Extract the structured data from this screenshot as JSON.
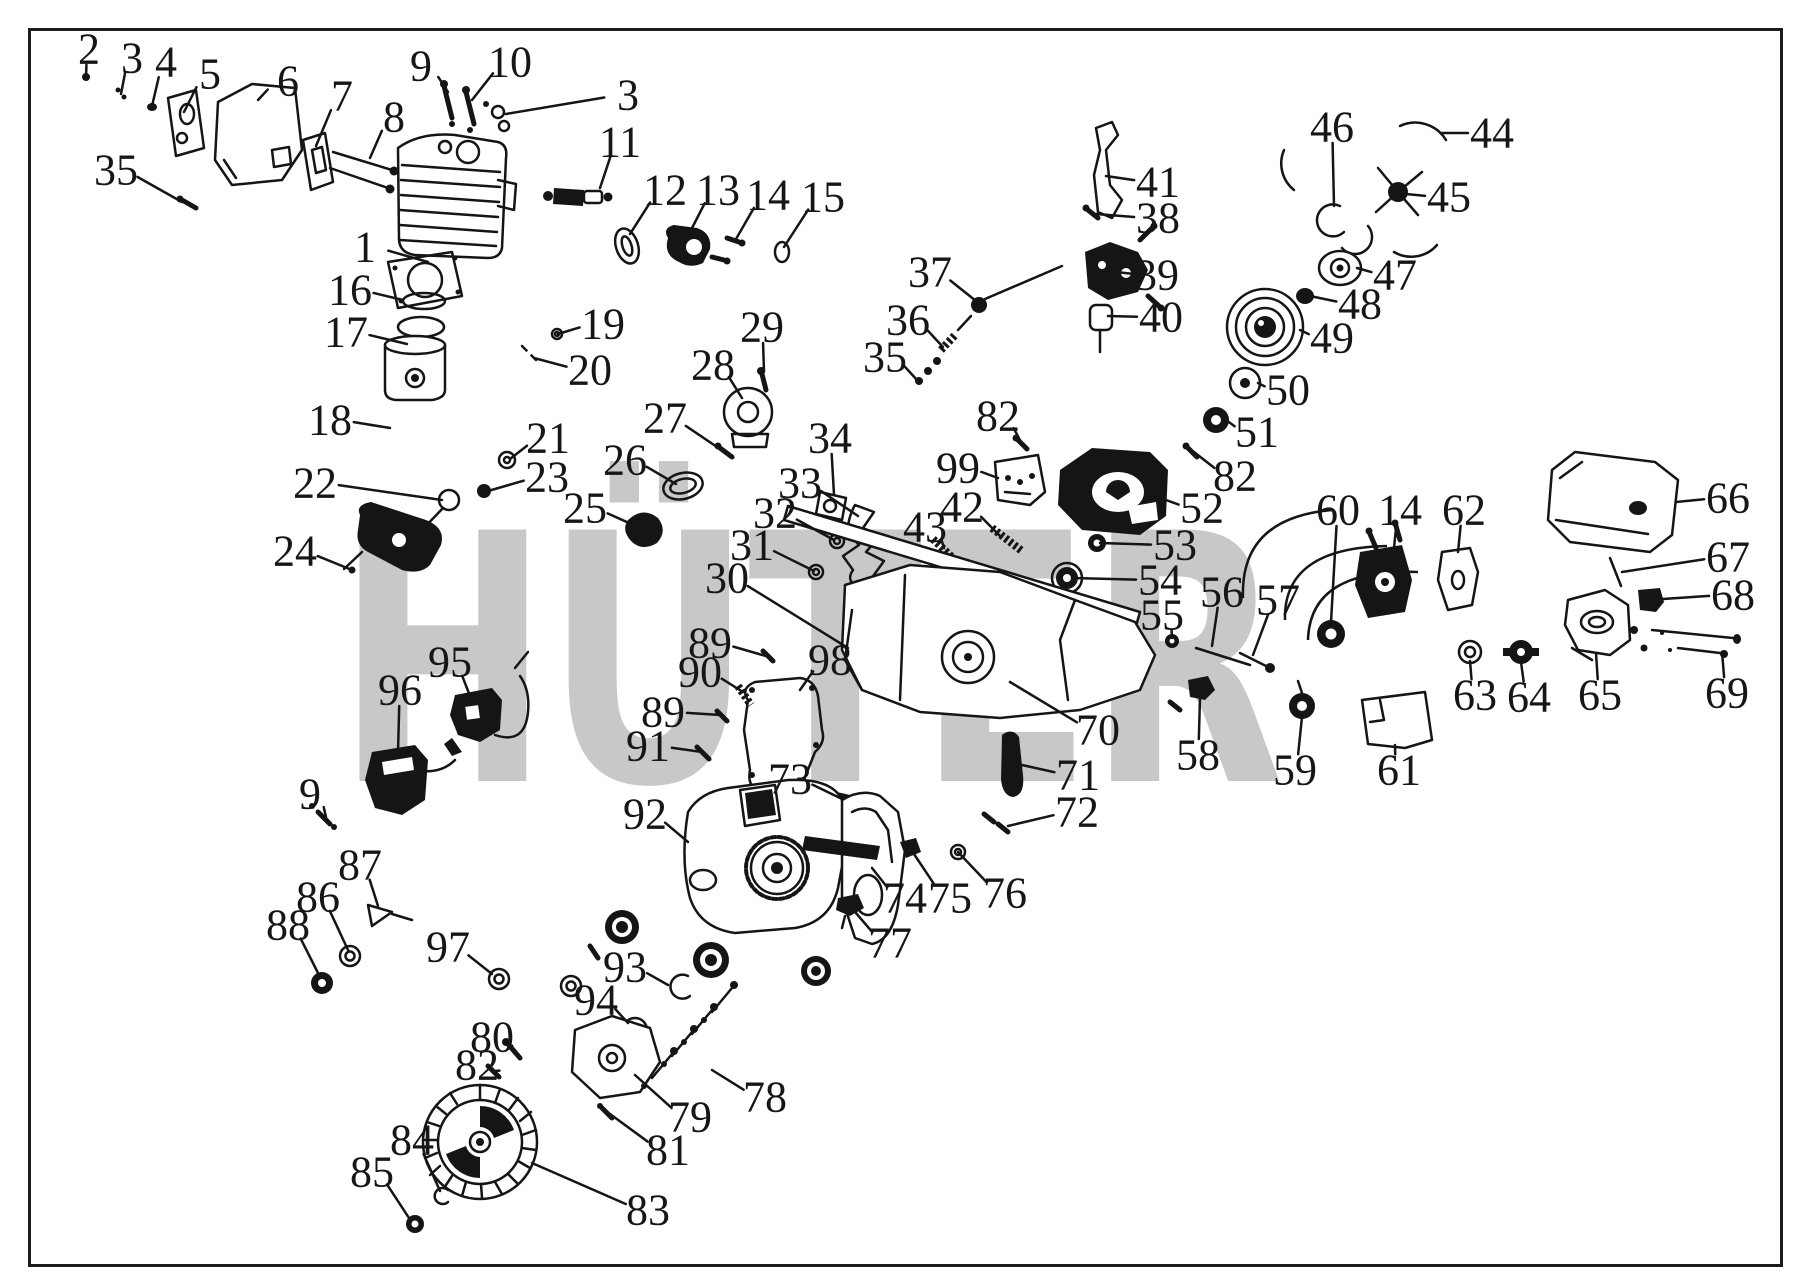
{
  "figure": {
    "type": "exploded-parts-diagram",
    "subject": "chainsaw engine assembly"
  },
  "watermark": {
    "text": "HÜTER",
    "text_color": "#c8c8c8",
    "emblem": {
      "gray": "#bdbdbd",
      "red": "#f0a0ab",
      "yellow": "#f6f2a6"
    }
  },
  "frame_color": "#1c1c1c",
  "ink_color": "#151515",
  "callouts": [
    {
      "n": "1",
      "x": 365,
      "y": 247,
      "tx": 428,
      "ty": 262
    },
    {
      "n": "2",
      "x": 89,
      "y": 49,
      "tx": 86,
      "ty": 77
    },
    {
      "n": "3",
      "x": 132,
      "y": 58,
      "tx": 121,
      "ty": 94
    },
    {
      "n": "3",
      "x": 628,
      "y": 95,
      "tx": 506,
      "ty": 114
    },
    {
      "n": "4",
      "x": 166,
      "y": 62,
      "tx": 152,
      "ty": 106
    },
    {
      "n": "5",
      "x": 210,
      "y": 74,
      "tx": 184,
      "ty": 112
    },
    {
      "n": "6",
      "x": 288,
      "y": 81,
      "tx": 258,
      "ty": 100
    },
    {
      "n": "7",
      "x": 342,
      "y": 96,
      "tx": 316,
      "ty": 146
    },
    {
      "n": "8",
      "x": 394,
      "y": 117,
      "tx": 370,
      "ty": 158
    },
    {
      "n": "9",
      "x": 421,
      "y": 66,
      "tx": 448,
      "ty": 92
    },
    {
      "n": "9",
      "x": 310,
      "y": 794,
      "tx": 326,
      "ty": 817
    },
    {
      "n": "10",
      "x": 510,
      "y": 62,
      "tx": 472,
      "ty": 100
    },
    {
      "n": "11",
      "x": 620,
      "y": 142,
      "tx": 600,
      "ty": 188
    },
    {
      "n": "12",
      "x": 665,
      "y": 190,
      "tx": 630,
      "ty": 234
    },
    {
      "n": "13",
      "x": 718,
      "y": 190,
      "tx": 690,
      "ty": 232
    },
    {
      "n": "14",
      "x": 768,
      "y": 195,
      "tx": 736,
      "ty": 239
    },
    {
      "n": "14",
      "x": 1400,
      "y": 510,
      "tx": 1394,
      "ty": 548
    },
    {
      "n": "15",
      "x": 823,
      "y": 197,
      "tx": 784,
      "ty": 247
    },
    {
      "n": "16",
      "x": 350,
      "y": 290,
      "tx": 403,
      "ty": 300
    },
    {
      "n": "17",
      "x": 346,
      "y": 332,
      "tx": 407,
      "ty": 344
    },
    {
      "n": "18",
      "x": 330,
      "y": 420,
      "tx": 390,
      "ty": 428
    },
    {
      "n": "19",
      "x": 603,
      "y": 324,
      "tx": 558,
      "ty": 334
    },
    {
      "n": "20",
      "x": 590,
      "y": 370,
      "tx": 534,
      "ty": 358
    },
    {
      "n": "21",
      "x": 548,
      "y": 438,
      "tx": 510,
      "ty": 459
    },
    {
      "n": "22",
      "x": 315,
      "y": 483,
      "tx": 442,
      "ty": 500
    },
    {
      "n": "23",
      "x": 547,
      "y": 477,
      "tx": 488,
      "ty": 491
    },
    {
      "n": "24",
      "x": 295,
      "y": 551,
      "tx": 352,
      "ty": 570
    },
    {
      "n": "25",
      "x": 585,
      "y": 508,
      "tx": 638,
      "ty": 527
    },
    {
      "n": "26",
      "x": 625,
      "y": 460,
      "tx": 676,
      "ty": 484
    },
    {
      "n": "27",
      "x": 665,
      "y": 418,
      "tx": 723,
      "ty": 451
    },
    {
      "n": "28",
      "x": 713,
      "y": 365,
      "tx": 742,
      "ty": 398
    },
    {
      "n": "29",
      "x": 762,
      "y": 327,
      "tx": 764,
      "ty": 372
    },
    {
      "n": "30",
      "x": 727,
      "y": 578,
      "tx": 848,
      "ty": 648
    },
    {
      "n": "31",
      "x": 752,
      "y": 545,
      "tx": 814,
      "ty": 571
    },
    {
      "n": "32",
      "x": 775,
      "y": 513,
      "tx": 834,
      "ty": 540
    },
    {
      "n": "33",
      "x": 800,
      "y": 483,
      "tx": 858,
      "ty": 516
    },
    {
      "n": "34",
      "x": 830,
      "y": 438,
      "tx": 834,
      "ty": 495
    },
    {
      "n": "35",
      "x": 116,
      "y": 170,
      "tx": 182,
      "ty": 202
    },
    {
      "n": "35",
      "x": 885,
      "y": 357,
      "tx": 917,
      "ty": 380
    },
    {
      "n": "36",
      "x": 908,
      "y": 320,
      "tx": 943,
      "ty": 347
    },
    {
      "n": "37",
      "x": 930,
      "y": 272,
      "tx": 976,
      "ty": 301
    },
    {
      "n": "38",
      "x": 1158,
      "y": 218,
      "tx": 1096,
      "ty": 214
    },
    {
      "n": "39",
      "x": 1157,
      "y": 275,
      "tx": 1116,
      "ty": 272
    },
    {
      "n": "40",
      "x": 1161,
      "y": 317,
      "tx": 1108,
      "ty": 316
    },
    {
      "n": "41",
      "x": 1158,
      "y": 182,
      "tx": 1106,
      "ty": 176
    },
    {
      "n": "42",
      "x": 962,
      "y": 507,
      "tx": 1000,
      "ty": 536
    },
    {
      "n": "43",
      "x": 925,
      "y": 527,
      "tx": 944,
      "ty": 548
    },
    {
      "n": "44",
      "x": 1492,
      "y": 133,
      "tx": 1442,
      "ty": 133
    },
    {
      "n": "45",
      "x": 1449,
      "y": 197,
      "tx": 1406,
      "ty": 194
    },
    {
      "n": "46",
      "x": 1332,
      "y": 127,
      "tx": 1334,
      "ty": 206
    },
    {
      "n": "47",
      "x": 1395,
      "y": 275,
      "tx": 1357,
      "ty": 268
    },
    {
      "n": "48",
      "x": 1360,
      "y": 304,
      "tx": 1310,
      "ty": 296
    },
    {
      "n": "49",
      "x": 1332,
      "y": 338,
      "tx": 1300,
      "ty": 330
    },
    {
      "n": "50",
      "x": 1288,
      "y": 390,
      "tx": 1258,
      "ty": 383
    },
    {
      "n": "51",
      "x": 1257,
      "y": 432,
      "tx": 1226,
      "ty": 420
    },
    {
      "n": "52",
      "x": 1202,
      "y": 508,
      "tx": 1166,
      "ty": 500
    },
    {
      "n": "53",
      "x": 1175,
      "y": 545,
      "tx": 1100,
      "ty": 543
    },
    {
      "n": "54",
      "x": 1160,
      "y": 580,
      "tx": 1072,
      "ty": 578
    },
    {
      "n": "55",
      "x": 1162,
      "y": 615,
      "tx": 1172,
      "ty": 638
    },
    {
      "n": "56",
      "x": 1222,
      "y": 592,
      "tx": 1212,
      "ty": 646
    },
    {
      "n": "57",
      "x": 1278,
      "y": 600,
      "tx": 1253,
      "ty": 655
    },
    {
      "n": "58",
      "x": 1198,
      "y": 755,
      "tx": 1200,
      "ty": 698
    },
    {
      "n": "59",
      "x": 1295,
      "y": 770,
      "tx": 1302,
      "ty": 717
    },
    {
      "n": "60",
      "x": 1338,
      "y": 510,
      "tx": 1331,
      "ty": 622
    },
    {
      "n": "61",
      "x": 1399,
      "y": 770,
      "tx": 1395,
      "ty": 745
    },
    {
      "n": "62",
      "x": 1464,
      "y": 510,
      "tx": 1458,
      "ty": 552
    },
    {
      "n": "63",
      "x": 1475,
      "y": 695,
      "tx": 1470,
      "ty": 661
    },
    {
      "n": "64",
      "x": 1529,
      "y": 697,
      "tx": 1521,
      "ty": 662
    },
    {
      "n": "65",
      "x": 1600,
      "y": 695,
      "tx": 1596,
      "ty": 653
    },
    {
      "n": "66",
      "x": 1728,
      "y": 498,
      "tx": 1676,
      "ty": 502
    },
    {
      "n": "67",
      "x": 1728,
      "y": 557,
      "tx": 1622,
      "ty": 572
    },
    {
      "n": "68",
      "x": 1733,
      "y": 595,
      "tx": 1663,
      "ty": 599
    },
    {
      "n": "69",
      "x": 1727,
      "y": 693,
      "tx": 1722,
      "ty": 652
    },
    {
      "n": "70",
      "x": 1098,
      "y": 730,
      "tx": 1010,
      "ty": 682
    },
    {
      "n": "71",
      "x": 1078,
      "y": 775,
      "tx": 1022,
      "ty": 765
    },
    {
      "n": "72",
      "x": 1077,
      "y": 812,
      "tx": 1008,
      "ty": 826
    },
    {
      "n": "73",
      "x": 790,
      "y": 779,
      "tx": 840,
      "ty": 798
    },
    {
      "n": "74",
      "x": 905,
      "y": 898,
      "tx": 872,
      "ty": 868
    },
    {
      "n": "75",
      "x": 950,
      "y": 898,
      "tx": 910,
      "ty": 848
    },
    {
      "n": "76",
      "x": 1005,
      "y": 893,
      "tx": 958,
      "ty": 852
    },
    {
      "n": "77",
      "x": 890,
      "y": 943,
      "tx": 850,
      "ty": 906
    },
    {
      "n": "78",
      "x": 765,
      "y": 1097,
      "tx": 712,
      "ty": 1070
    },
    {
      "n": "79",
      "x": 690,
      "y": 1117,
      "tx": 635,
      "ty": 1075
    },
    {
      "n": "80",
      "x": 492,
      "y": 1037,
      "tx": 512,
      "ty": 1050
    },
    {
      "n": "81",
      "x": 668,
      "y": 1150,
      "tx": 610,
      "ty": 1114
    },
    {
      "n": "82",
      "x": 998,
      "y": 416,
      "tx": 1022,
      "ty": 444
    },
    {
      "n": "82",
      "x": 1235,
      "y": 476,
      "tx": 1194,
      "ty": 452
    },
    {
      "n": "82",
      "x": 477,
      "y": 1065,
      "tx": 493,
      "ty": 1071
    },
    {
      "n": "83",
      "x": 648,
      "y": 1210,
      "tx": 532,
      "ty": 1163
    },
    {
      "n": "84",
      "x": 412,
      "y": 1140,
      "tx": 440,
      "ty": 1191
    },
    {
      "n": "85",
      "x": 372,
      "y": 1172,
      "tx": 409,
      "ty": 1218
    },
    {
      "n": "86",
      "x": 318,
      "y": 897,
      "tx": 348,
      "ty": 950
    },
    {
      "n": "87",
      "x": 360,
      "y": 865,
      "tx": 378,
      "ty": 906
    },
    {
      "n": "88",
      "x": 288,
      "y": 925,
      "tx": 319,
      "ty": 975
    },
    {
      "n": "89",
      "x": 710,
      "y": 643,
      "tx": 766,
      "ty": 656
    },
    {
      "n": "89",
      "x": 663,
      "y": 712,
      "tx": 721,
      "ty": 715
    },
    {
      "n": "90",
      "x": 700,
      "y": 672,
      "tx": 743,
      "ty": 692
    },
    {
      "n": "91",
      "x": 648,
      "y": 746,
      "tx": 702,
      "ty": 752
    },
    {
      "n": "92",
      "x": 645,
      "y": 814,
      "tx": 688,
      "ty": 842
    },
    {
      "n": "93",
      "x": 625,
      "y": 967,
      "tx": 668,
      "ty": 985
    },
    {
      "n": "94",
      "x": 596,
      "y": 1000,
      "tx": 628,
      "ty": 1023
    },
    {
      "n": "95",
      "x": 450,
      "y": 662,
      "tx": 470,
      "ty": 696
    },
    {
      "n": "96",
      "x": 400,
      "y": 690,
      "tx": 398,
      "ty": 752
    },
    {
      "n": "97",
      "x": 448,
      "y": 947,
      "tx": 492,
      "ty": 974
    },
    {
      "n": "98",
      "x": 830,
      "y": 660,
      "tx": 800,
      "ty": 690
    },
    {
      "n": "99",
      "x": 958,
      "y": 468,
      "tx": 998,
      "ty": 478
    }
  ]
}
